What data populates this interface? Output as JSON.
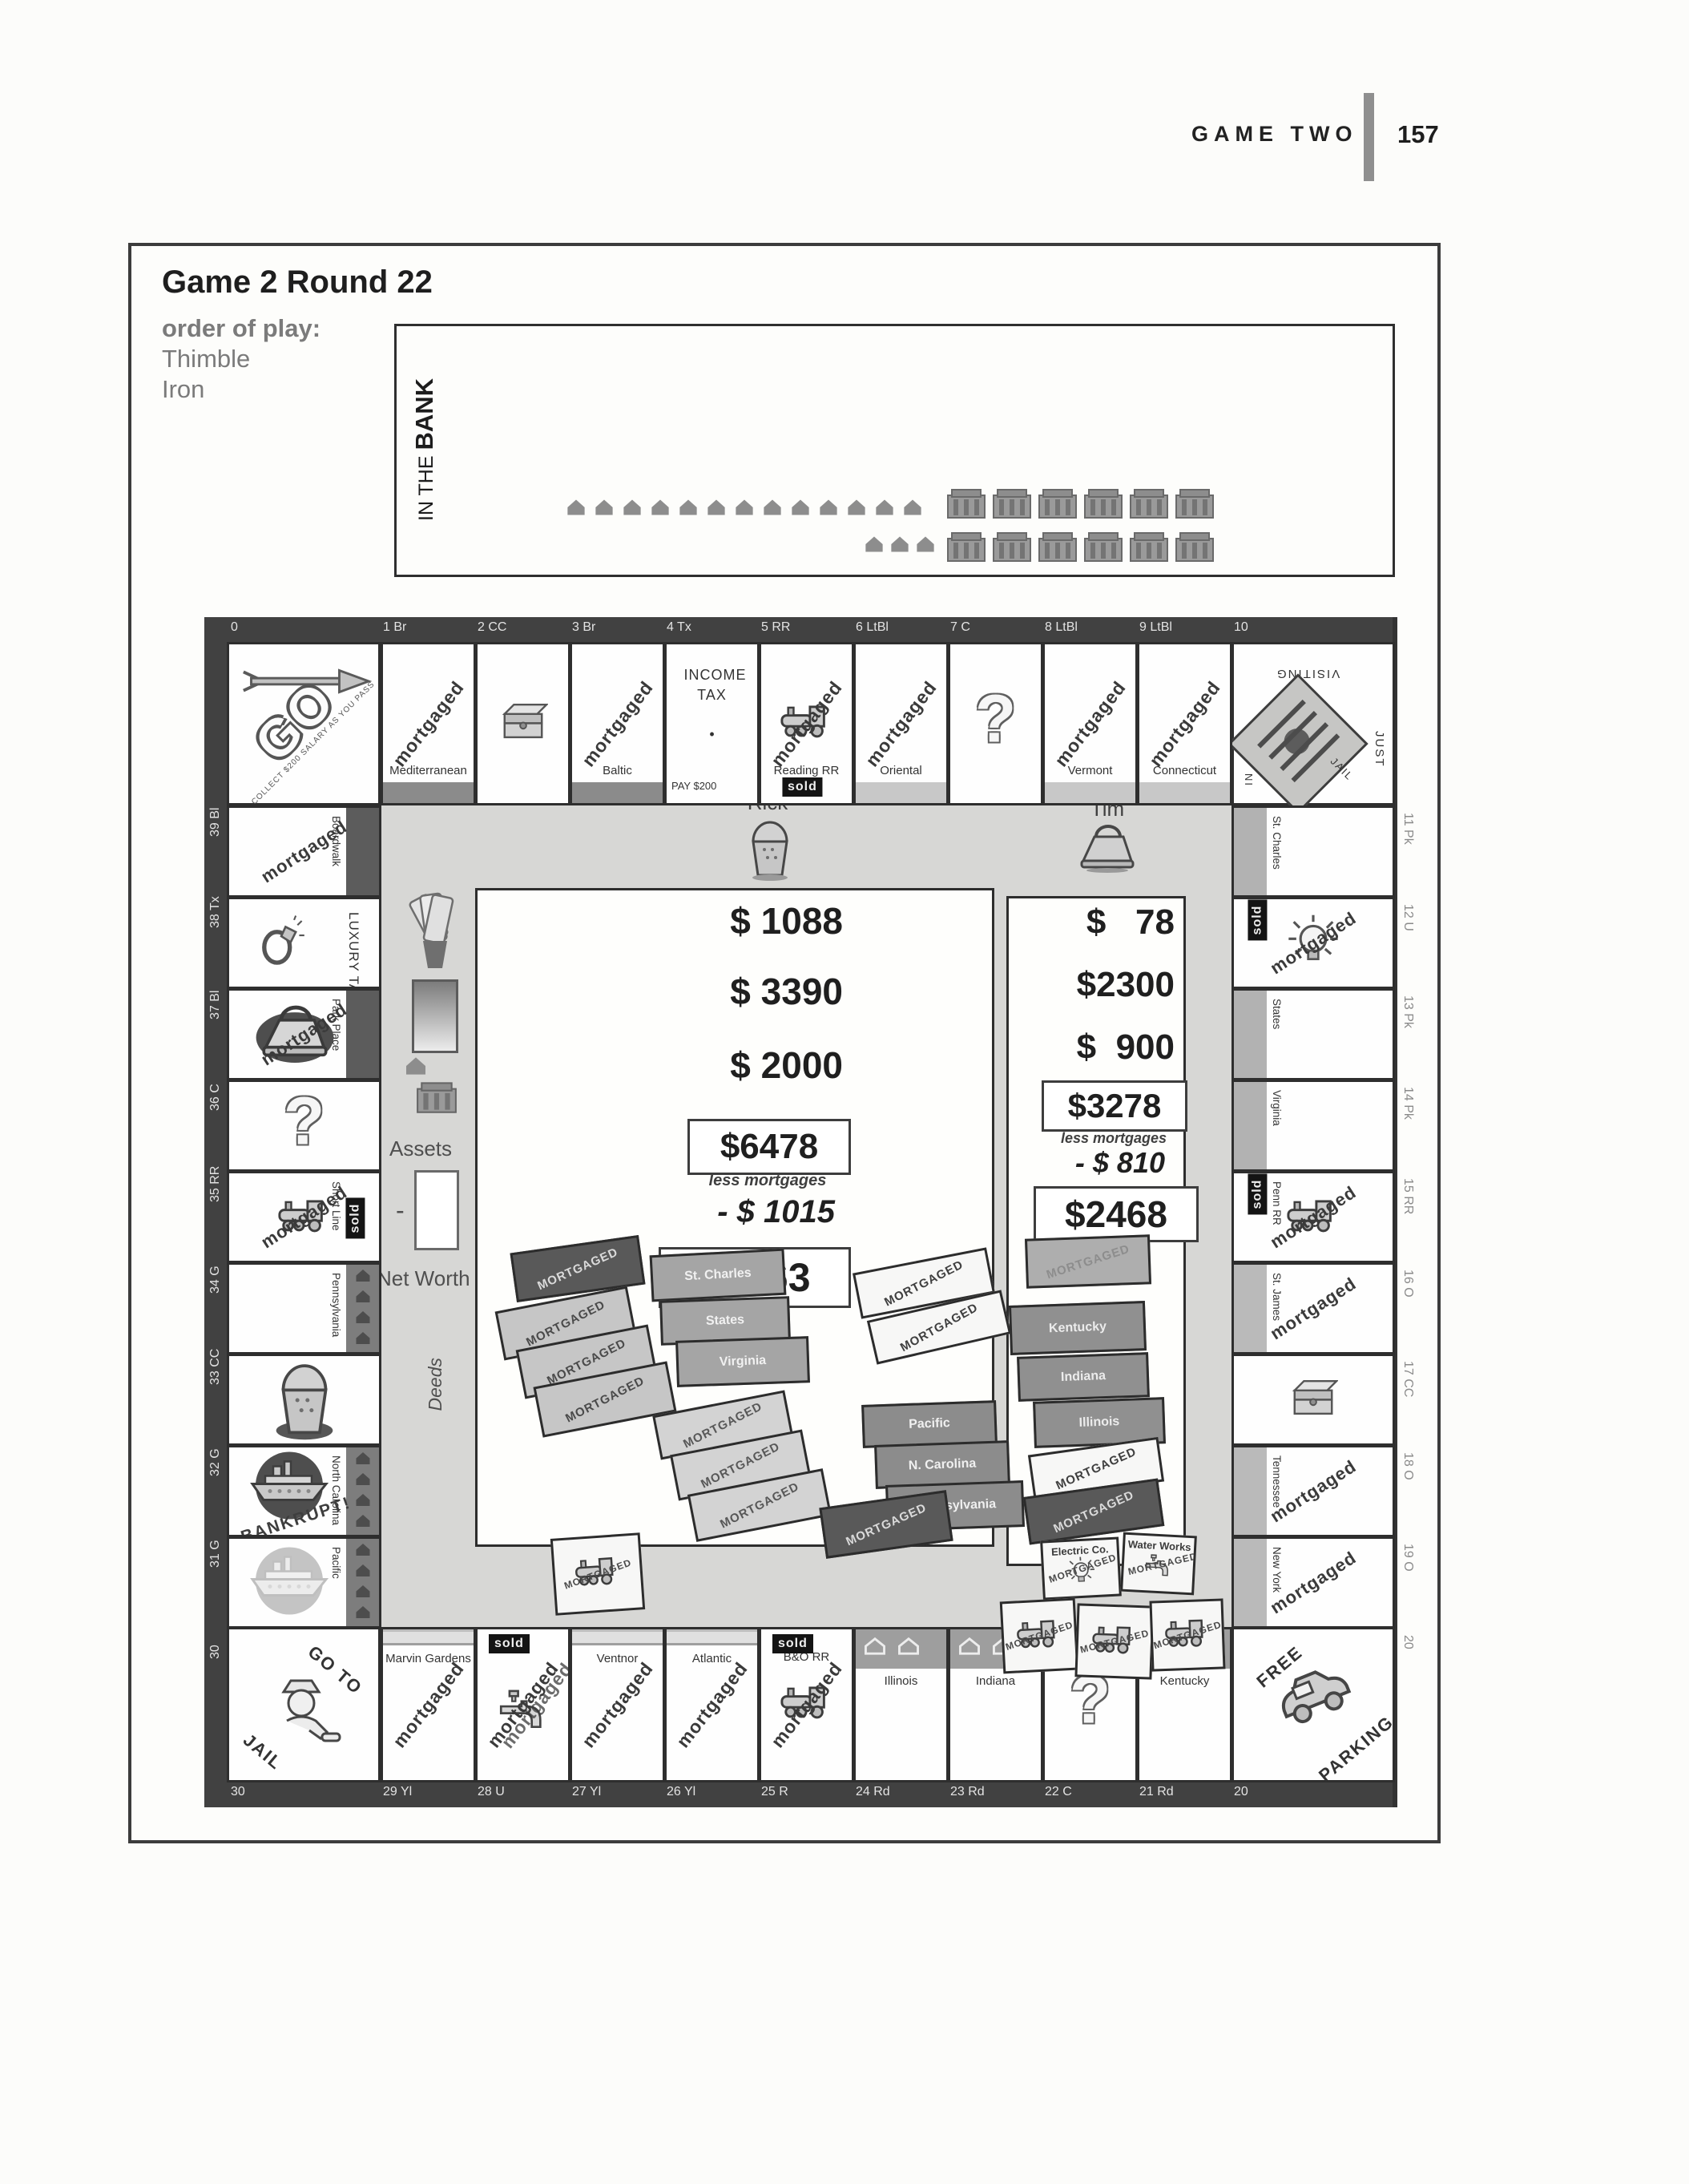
{
  "page": {
    "header_title": "GAME TWO",
    "page_number": "157"
  },
  "panel": {
    "title": "Game 2 Round 22",
    "order_label": "order of play:",
    "order": [
      "Thimble",
      "Iron"
    ],
    "bank": {
      "line1": "IN THE",
      "line2": "BANK",
      "row1_houses": 13,
      "row1_hotels": 6,
      "row2_houses": 3,
      "row2_hotels": 6
    }
  },
  "labels": {
    "mortgaged": "mortgaged",
    "sold": "sold",
    "deed_mortgaged": "MORTGAGED",
    "assets": "Assets",
    "net_worth": "Net Worth",
    "deeds": "Deeds",
    "minus": "-"
  },
  "players": [
    {
      "name": "Rick",
      "token": "thimble",
      "cash": [
        "$ 1088",
        "$ 3390",
        "$ 2000"
      ],
      "assets_total": "$6478",
      "less_label": "less mortgages",
      "less_value": "- $ 1015",
      "net_worth": "$5463"
    },
    {
      "name": "Tim",
      "token": "iron",
      "cash": [
        "$   78",
        "$2300",
        "$  900"
      ],
      "assets_total": "$3278",
      "less_label": "less mortgages",
      "less_value": "- $ 810",
      "net_worth": "$2468"
    }
  ],
  "board": {
    "top_ruler": [
      "0",
      "1 Br",
      "2 CC",
      "3 Br",
      "4 Tx",
      "5 RR",
      "6 LtBl",
      "7 C",
      "8 LtBl",
      "9 LtBl",
      "10"
    ],
    "bottom_ruler": [
      "30",
      "29 Yl",
      "28 U",
      "27 Yl",
      "26 Yl",
      "25 R",
      "24 Rd",
      "23 Rd",
      "22 C",
      "21 Rd",
      "20"
    ],
    "left_ruler": [
      "39 Bl",
      "38 Tx",
      "37 Bl",
      "36 C",
      "35 RR",
      "34 G",
      "33 CC",
      "32 G",
      "31 G",
      "30"
    ],
    "right_ruler": [
      "11 Pk",
      "12 U",
      "13 Pk",
      "14 Pk",
      "15 RR",
      "16 O",
      "17 CC",
      "18 O",
      "19 O",
      "20"
    ],
    "corners": {
      "go": {
        "label": "GO",
        "caption": "COLLECT $200 SALARY AS YOU PASS"
      },
      "jail": {
        "visiting": "VISITING",
        "just": "JUST",
        "in_label": "IN",
        "jail_label": "JAIL"
      },
      "free_parking": {
        "line1": "FREE",
        "line2": "PARKING"
      },
      "go_to_jail": {
        "line1": "GO TO",
        "line2": "JAIL"
      }
    },
    "top_cells": [
      {
        "name": "Mediterranean",
        "mortgaged": true,
        "bar": "brown"
      },
      {
        "icon": "chest"
      },
      {
        "name": "Baltic",
        "mortgaged": true,
        "bar": "brown"
      },
      {
        "type": "incometax",
        "name": "INCOME TAX",
        "dot": "•",
        "sub": "PAY $200"
      },
      {
        "name": "Reading RR",
        "mortgaged": true,
        "sold": "bottom",
        "icon": "train"
      },
      {
        "name": "Oriental",
        "mortgaged": true,
        "bar": "ltblue"
      },
      {
        "icon": "question"
      },
      {
        "name": "Vermont",
        "mortgaged": true,
        "bar": "ltblue"
      },
      {
        "name": "Connecticut",
        "mortgaged": true,
        "bar": "ltblue"
      }
    ],
    "right_cells": [
      {
        "name": "St. Charles",
        "bar": "pink"
      },
      {
        "icon": "bulb",
        "mortgaged": true,
        "sold": "left"
      },
      {
        "name": "States",
        "bar": "pink"
      },
      {
        "name": "Virginia",
        "bar": "pink"
      },
      {
        "name": "Penn RR",
        "mortgaged": true,
        "sold": "left",
        "icon": "train"
      },
      {
        "name": "St. James",
        "mortgaged": true,
        "bar": "orange"
      },
      {
        "icon": "chest"
      },
      {
        "name": "Tennessee",
        "mortgaged": true,
        "bar": "orange"
      },
      {
        "name": "New York",
        "mortgaged": true,
        "bar": "orange"
      }
    ],
    "bottom_cells": [
      {
        "name": "Marvin Gardens",
        "mortgaged": true,
        "bar": "yellow"
      },
      {
        "icon": "faucet",
        "mortgaged": true,
        "double_mort": true,
        "sold": "top"
      },
      {
        "name": "Ventnor",
        "mortgaged": true,
        "bar": "yellow"
      },
      {
        "name": "Atlantic",
        "mortgaged": true,
        "bar": "yellow"
      },
      {
        "name": "B&O RR",
        "mortgaged": true,
        "sold": "top",
        "icon": "train"
      },
      {
        "name": "Illinois",
        "bar": "red",
        "houses": 2
      },
      {
        "name": "Indiana",
        "bar": "red",
        "houses": 2
      },
      {
        "icon": "question"
      },
      {
        "name": "Kentucky",
        "bar": "red",
        "houses": 2
      }
    ],
    "left_cells": [
      {
        "name": "Boardwalk",
        "mortgaged": true,
        "bar": "darkblue"
      },
      {
        "type": "luxurytax",
        "name": "LUXURY TAX",
        "icon": "ring"
      },
      {
        "name": "Park Place",
        "mortgaged": true,
        "bar": "darkblue",
        "token": "iron"
      },
      {
        "icon": "question"
      },
      {
        "name": "Short Line",
        "mortgaged": true,
        "sold": "right",
        "icon": "train"
      },
      {
        "name": "Pennsylvania",
        "bar": "green",
        "houses": 4
      },
      {
        "token": "thimble"
      },
      {
        "name": "North Carolina",
        "bar": "green",
        "houses": 4,
        "token": "ship",
        "note": "BANKRUPT!"
      },
      {
        "name": "Pacific",
        "bar": "green",
        "houses": 4,
        "token": "ship-faded"
      }
    ]
  },
  "deeds": {
    "rick": [
      {
        "label": "MORTGAGED",
        "tone": "dark"
      },
      {
        "label": "MORTGAGED",
        "tone": "light"
      },
      {
        "label": "MORTGAGED",
        "tone": "light"
      },
      {
        "label": "MORTGAGED",
        "tone": "light"
      },
      {
        "label": "St. Charles",
        "tone": "pink"
      },
      {
        "label": "States",
        "tone": "pink"
      },
      {
        "label": "Virginia",
        "tone": "pink"
      },
      {
        "label": "MORTGAGED",
        "tone": "white"
      },
      {
        "label": "MORTGAGED",
        "tone": "white"
      },
      {
        "label": "MORTGAGED",
        "tone": "lighter"
      },
      {
        "label": "MORTGAGED",
        "tone": "lighter"
      },
      {
        "label": "MORTGAGED",
        "tone": "lighter"
      },
      {
        "label": "Pacific",
        "tone": "green"
      },
      {
        "label": "N. Carolina",
        "tone": "green"
      },
      {
        "label": "Pennsylvania",
        "tone": "green"
      },
      {
        "label": "MORTGAGED",
        "tone": "white",
        "train": true
      },
      {
        "label": "MORTGAGED",
        "tone": "dark"
      }
    ],
    "tim": [
      {
        "label": "MORTGAGED",
        "tone": "mid"
      },
      {
        "label": "Kentucky",
        "tone": "red"
      },
      {
        "label": "Indiana",
        "tone": "red"
      },
      {
        "label": "Illinois",
        "tone": "red"
      },
      {
        "label": "MORTGAGED",
        "tone": "white"
      },
      {
        "label": "MORTGAGED",
        "tone": "dark"
      },
      {
        "label": "Electric Co.",
        "tone": "white",
        "util": "bulb",
        "mort": true
      },
      {
        "label": "Water Works",
        "tone": "white",
        "util": "faucet",
        "mort": true
      },
      {
        "label": "MORTGAGED",
        "tone": "white",
        "train": true
      },
      {
        "label": "MORTGAGED",
        "tone": "white",
        "train": true
      },
      {
        "label": "MORTGAGED",
        "tone": "white",
        "train": true
      }
    ]
  }
}
